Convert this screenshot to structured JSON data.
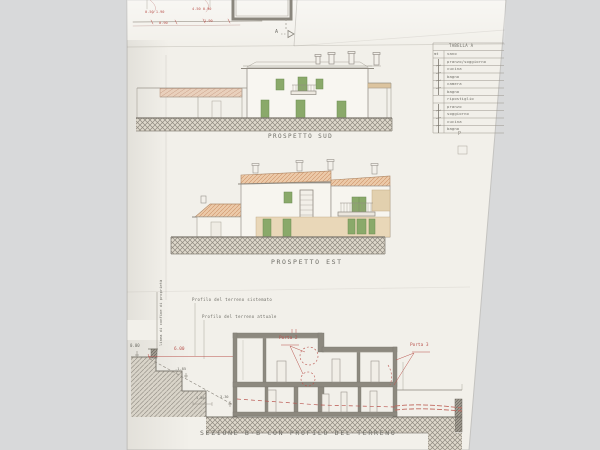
{
  "document_type": "architectural drawing photo",
  "elevations": {
    "sud_label": "PROSPETTO SUD",
    "est_label": "PROSPETTO EST"
  },
  "section": {
    "label": "SEZIONE B-B CON PROFILO DEL TERRENO",
    "porta2": "Porta 2",
    "porta3": "Porta 3",
    "profilo_sistemato": "Profilo del terreno sistemato",
    "profilo_attuale": "Profilo del terreno attuale",
    "confine": "linea di confine di proprietà",
    "levels": {
      "zero": "0.00",
      "dim6": "6.00",
      "m185": "-1.85",
      "dim150": "1.50",
      "m330": "-3.30"
    }
  },
  "plan_fragment": {
    "marker": "A",
    "dims": [
      "0.50 1.90",
      "4.50 0.90",
      "0.90",
      "1.90"
    ],
    "partial_label": "P"
  },
  "legend_table": {
    "title": "TABELLA A",
    "unit_header": "mt",
    "rows": [
      "vano",
      "pranzo/soggiorno",
      "cucina",
      "bagno",
      "camera",
      "bagno",
      "ripostiglio",
      "pranzo",
      "soggiorno",
      "cucina",
      "bagno"
    ]
  },
  "colors": {
    "background": "#d8d9da",
    "paper": "#f2f0ea",
    "line_gray": "#8f8a81",
    "wall_fill": "#8d897f",
    "shutter_green": "#8aa96a",
    "roof_terracotta": "#eccaa9",
    "stone_band": "#e9d0bc",
    "tan_wall": "#e9d7b8",
    "annotation_red": "#b9534d"
  }
}
